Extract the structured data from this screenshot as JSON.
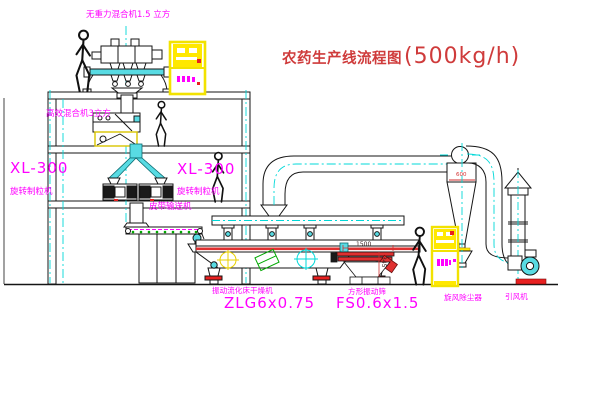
{
  "title": {
    "name": "农药生产线流程图",
    "capacity": "(500kg/h)"
  },
  "labels": {
    "gravity_mixer": "无重力混合机1.5 立方",
    "mixer2": "高效混合机3立方",
    "granulator_model": "XL-300",
    "granulator_name": "旋转制粒机",
    "belt_conveyor": "皮带输送机",
    "dryer_name": "振动流化床干燥机",
    "dryer_model": "ZLG6x0.75",
    "screen_name": "方形振动筛",
    "screen_model": "FS0.6x1.5",
    "cyclone": "旋风除尘器",
    "fan": "引风机"
  },
  "dimensions": {
    "screen_length": "1500",
    "screen_height": "345",
    "cyclone_dia": "600"
  },
  "colors": {
    "label_magenta": "#ff00ff",
    "title_red": "#cf3b3b",
    "centerline_cyan": "#00d8d8",
    "cabinet_yellow": "#f2e200",
    "accent_red": "#e82020",
    "accent_green": "#00a800",
    "line_black": "#151515"
  }
}
